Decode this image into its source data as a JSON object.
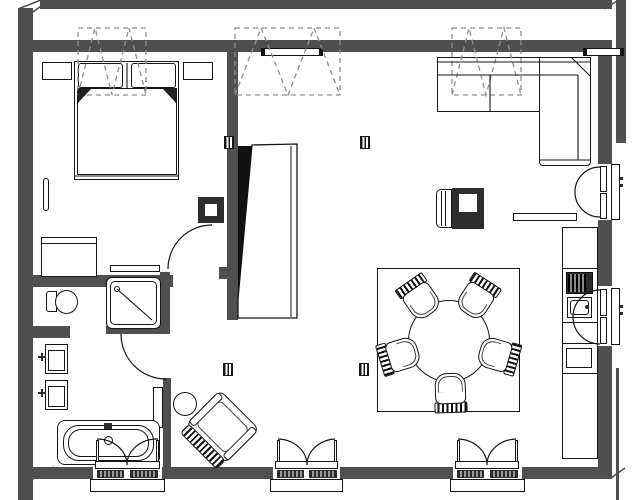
{
  "meta": {
    "type": "architectural-floor-plan",
    "background": "#ffffff"
  },
  "colors": {
    "wall": "#4f4f4f",
    "line": "#161616",
    "dashed": "#8f8f8f",
    "fixture": "#2e2e2e"
  },
  "inventory": {
    "rooms": [
      "bedroom",
      "bathroom",
      "hall",
      "living-dining",
      "kitchen-wall"
    ],
    "doors": [
      "bedroom-door",
      "bathroom-door",
      "partition-panel"
    ],
    "windows": {
      "bottom_casement": 3,
      "right_casement": 2,
      "skylights_dashed": 3
    },
    "furniture": [
      "double-bed",
      "pillow",
      "nightstand-left",
      "nightstand-right",
      "dresser",
      "wall-shelf-bedroom",
      "radiator-left",
      "radiator-top",
      "toilet",
      "washbasin-1",
      "washbasin-2",
      "shower",
      "bathtub",
      "lounge-chair",
      "side-table",
      "armchair",
      "stove-fireplace",
      "wall-shelf-living",
      "sectional-sofa",
      "dining-rug",
      "dining-table",
      "dining-chair-x5",
      "kitchen-counter",
      "cooktop",
      "kitchen-sink",
      "kitchen-cabinet",
      "structural-column"
    ]
  }
}
